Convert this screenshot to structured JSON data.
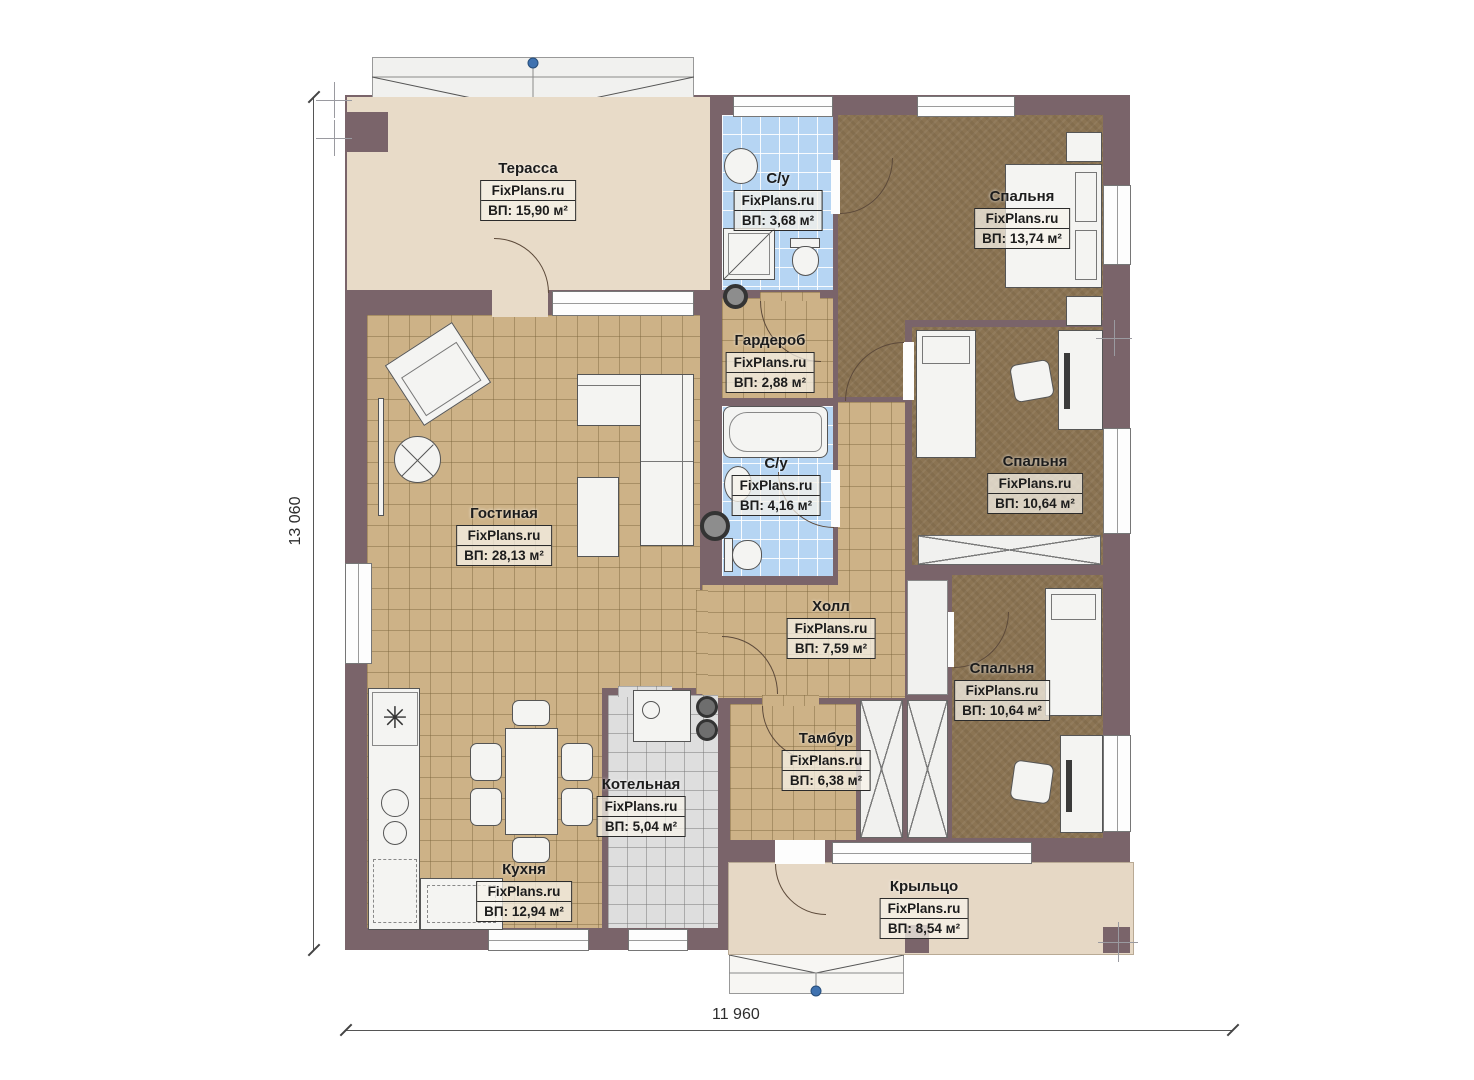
{
  "plan": {
    "watermark": "FixPlans.ru",
    "rooms": [
      {
        "id": "terrace",
        "name": "Терасса",
        "area": "ВП: 15,90 м²"
      },
      {
        "id": "bath1",
        "name": "С/у",
        "area": "ВП: 3,68 м²"
      },
      {
        "id": "bedroom1",
        "name": "Спальня",
        "area": "ВП: 13,74 м²"
      },
      {
        "id": "wardrobe",
        "name": "Гардероб",
        "area": "ВП: 2,88 м²"
      },
      {
        "id": "bath2",
        "name": "С/у",
        "area": "ВП: 4,16 м²"
      },
      {
        "id": "living",
        "name": "Гостиная",
        "area": "ВП: 28,13 м²"
      },
      {
        "id": "bedroom2",
        "name": "Спальня",
        "area": "ВП: 10,64 м²"
      },
      {
        "id": "hall",
        "name": "Холл",
        "area": "ВП: 7,59 м²"
      },
      {
        "id": "bedroom3",
        "name": "Спальня",
        "area": "ВП: 10,64 м²"
      },
      {
        "id": "tambour",
        "name": "Тамбур",
        "area": "ВП: 6,38 м²"
      },
      {
        "id": "boiler",
        "name": "Котельная",
        "area": "ВП: 5,04 м²"
      },
      {
        "id": "kitchen",
        "name": "Кухня",
        "area": "ВП: 12,94 м²"
      },
      {
        "id": "porch",
        "name": "Крыльцо",
        "area": "ВП: 8,54 м²"
      }
    ],
    "dimensions": {
      "height": "13 060",
      "width": "11 960"
    }
  }
}
